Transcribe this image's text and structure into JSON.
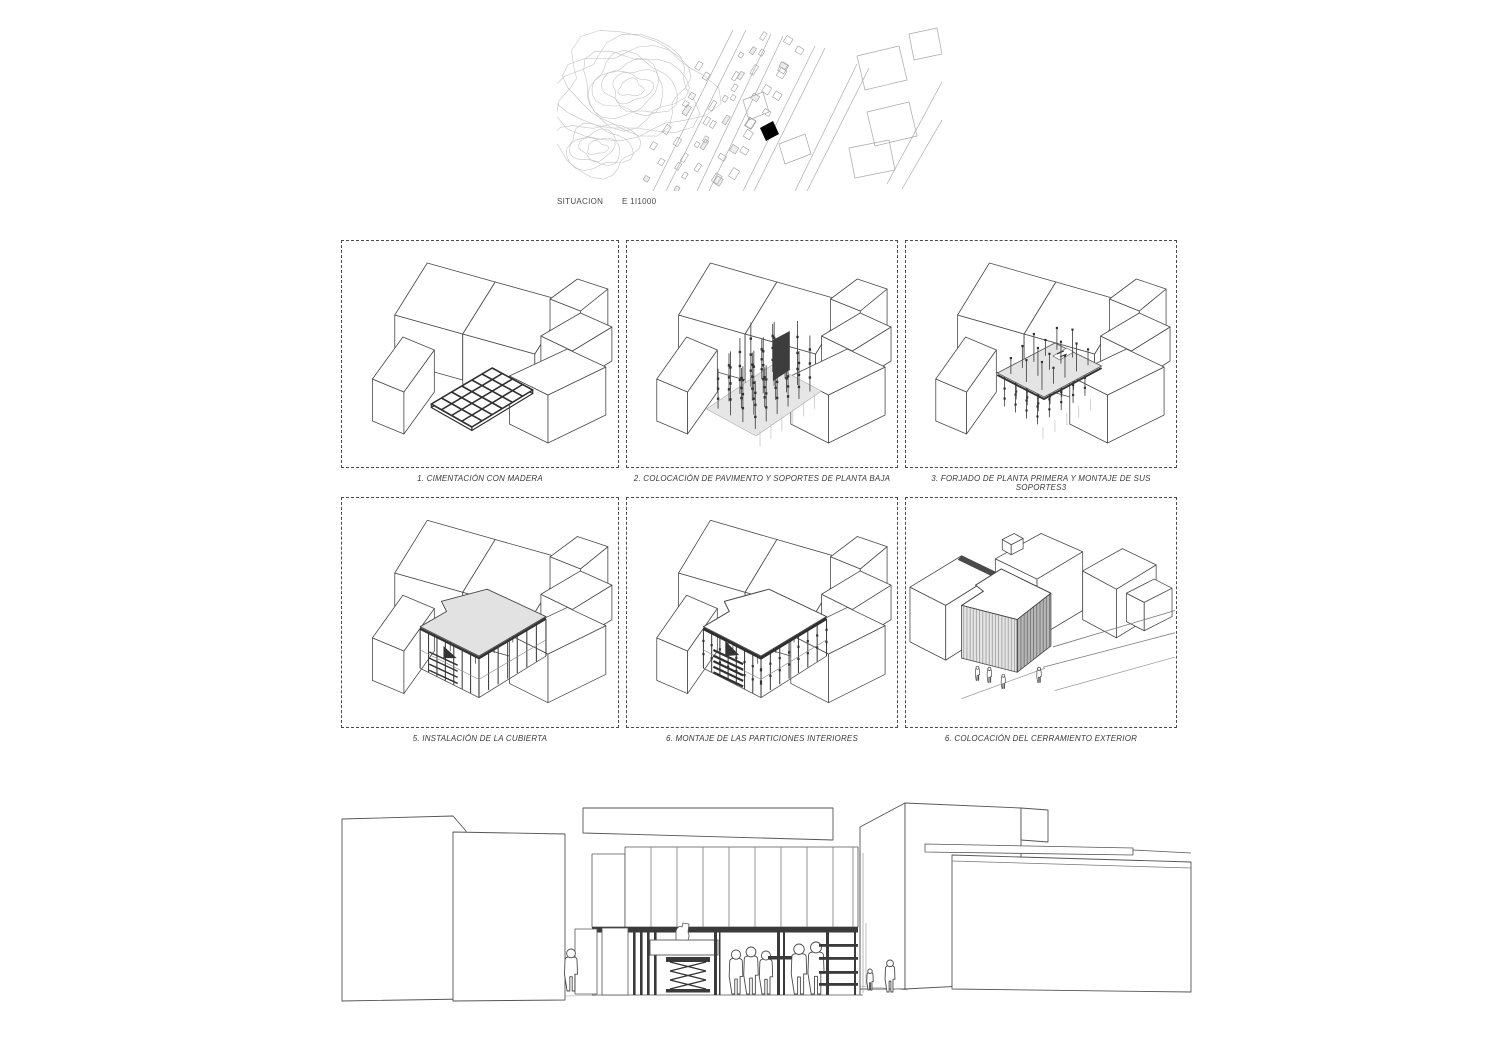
{
  "map": {
    "title": "SITUACION",
    "scale": "E  1I1000"
  },
  "panels": [
    {
      "caption": "1. CIMENTACIÓN CON MADERA"
    },
    {
      "caption": "2. COLOCACIÓN DE PAVIMENTO Y SOPORTES DE PLANTA BAJA"
    },
    {
      "caption": "3. FORJADO DE PLANTA PRIMERA Y MONTAJE DE SUS SOPORTES3"
    },
    {
      "caption": "5. INSTALACIÓN DE LA CUBIERTA"
    },
    {
      "caption": "6. MONTAJE DE LAS PARTICIONES INTERIORES"
    },
    {
      "caption": "6. COLOCACIÓN DEL CERRAMIENTO EXTERIOR"
    }
  ],
  "colors": {
    "line": "#4a4a4a",
    "light": "#9a9a9a",
    "slab": "#e2e2e2",
    "dark": "#333333",
    "marker": "#000000"
  }
}
